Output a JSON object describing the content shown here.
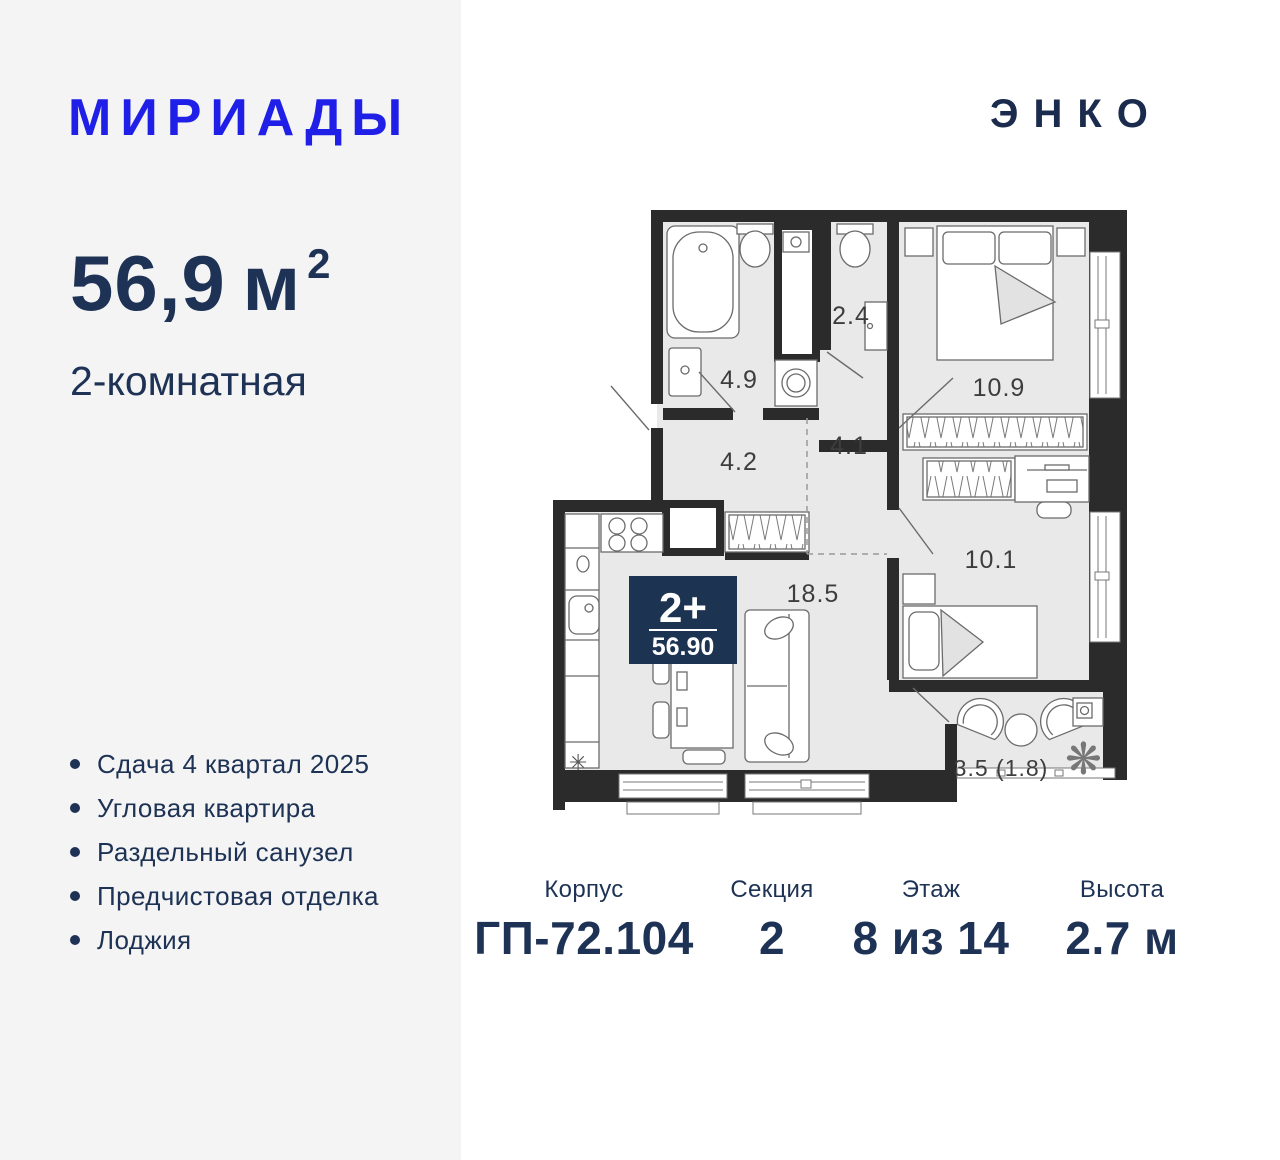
{
  "header": {
    "brand": "МИРИАДЫ",
    "developer": "ЭНКО"
  },
  "summary": {
    "area_value": "56,9",
    "area_unit": "м",
    "area_sup": "2",
    "room_type": "2-комнатная"
  },
  "features": {
    "items": [
      "Сдача 4 квартал 2025",
      "Угловая квартира",
      "Раздельный санузел",
      "Предчистовая отделка",
      "Лоджия"
    ]
  },
  "plan": {
    "badge": {
      "rooms": "2+",
      "area": "56.90"
    },
    "rooms": [
      {
        "name": "bathroom",
        "area": "4.9"
      },
      {
        "name": "wc",
        "area": "2.4"
      },
      {
        "name": "bedroom",
        "area": "10.9"
      },
      {
        "name": "hallway",
        "area": "4.2"
      },
      {
        "name": "corridor",
        "area": "4.1"
      },
      {
        "name": "bedroom-2",
        "area": "10.1"
      },
      {
        "name": "kitchen-living",
        "area": "18.5"
      },
      {
        "name": "loggia",
        "area": "3.5 (1.8)"
      }
    ],
    "icons": {
      "fridge": "✳",
      "plant": "❋"
    }
  },
  "specs": {
    "columns": [
      {
        "label": "Корпус",
        "value": "ГП-72.104"
      },
      {
        "label": "Секция",
        "value": "2"
      },
      {
        "label": "Этаж",
        "value": "8 из 14"
      },
      {
        "label": "Высота",
        "value": "2.7 м"
      }
    ]
  },
  "colors": {
    "brand_blue": "#1f1fe8",
    "navy_text": "#1d3254",
    "badge_bg": "#1d3352",
    "wall": "#2b2b2b",
    "floor": "#e9e9e9",
    "panel_bg": "#f4f4f4"
  }
}
